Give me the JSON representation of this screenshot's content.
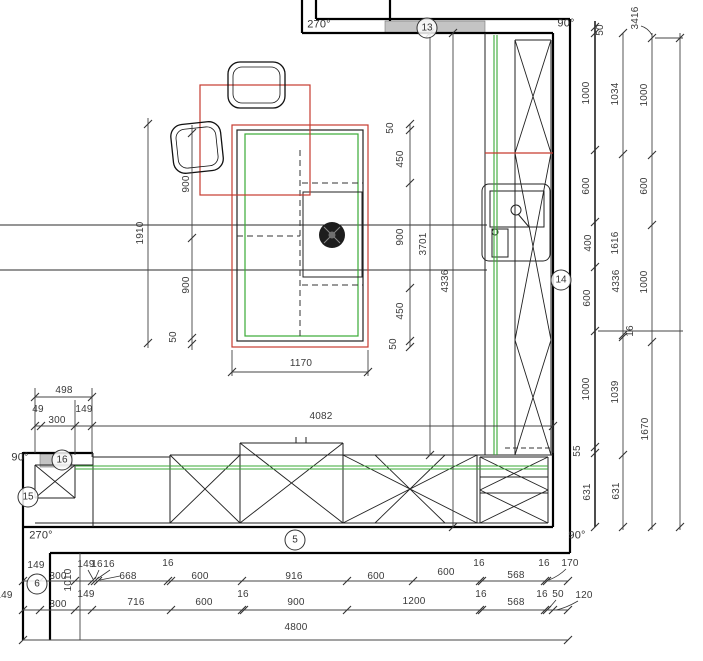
{
  "plan": {
    "description": "kitchen floor plan with dimension chains",
    "colors": {
      "wall": "#000000",
      "cabinet_outline": "#222222",
      "counter_green": "#3aaa35",
      "highlight_red": "#c63b2f",
      "dimension": "#3d3d3d",
      "opening_gray": "#c4c4c4"
    },
    "angle_labels": [
      {
        "t": "270°",
        "x": 319,
        "y": 25
      },
      {
        "t": "90°",
        "x": 566,
        "y": 24
      },
      {
        "t": "90°",
        "x": 20,
        "y": 458
      },
      {
        "t": "270°",
        "x": 41,
        "y": 536
      },
      {
        "t": "90°",
        "x": 577,
        "y": 536
      }
    ],
    "dimension_labels": [
      {
        "t": "50",
        "x": 601,
        "y": 30,
        "o": "v"
      },
      {
        "t": "3416",
        "x": 636,
        "y": 18,
        "o": "v"
      },
      {
        "t": "1000",
        "x": 587,
        "y": 93,
        "o": "v"
      },
      {
        "t": "1034",
        "x": 616,
        "y": 94,
        "o": "v"
      },
      {
        "t": "1000",
        "x": 645,
        "y": 95,
        "o": "v"
      },
      {
        "t": "600",
        "x": 587,
        "y": 186,
        "o": "v"
      },
      {
        "t": "600",
        "x": 645,
        "y": 186,
        "o": "v"
      },
      {
        "t": "400",
        "x": 589,
        "y": 243,
        "o": "v"
      },
      {
        "t": "1616",
        "x": 616,
        "y": 243,
        "o": "v"
      },
      {
        "t": "600",
        "x": 588,
        "y": 298,
        "o": "v"
      },
      {
        "t": "4336",
        "x": 617,
        "y": 281,
        "o": "v"
      },
      {
        "t": "1000",
        "x": 645,
        "y": 282,
        "o": "v"
      },
      {
        "t": "16",
        "x": 631,
        "y": 331,
        "o": "v"
      },
      {
        "t": "1000",
        "x": 587,
        "y": 389,
        "o": "v"
      },
      {
        "t": "1039",
        "x": 616,
        "y": 392,
        "o": "v"
      },
      {
        "t": "1670",
        "x": 646,
        "y": 429,
        "o": "v"
      },
      {
        "t": "55",
        "x": 578,
        "y": 451,
        "o": "v"
      },
      {
        "t": "631",
        "x": 588,
        "y": 492,
        "o": "v"
      },
      {
        "t": "631",
        "x": 617,
        "y": 491,
        "o": "v"
      },
      {
        "t": "50",
        "x": 391,
        "y": 128,
        "o": "v"
      },
      {
        "t": "450",
        "x": 401,
        "y": 159,
        "o": "v"
      },
      {
        "t": "900",
        "x": 401,
        "y": 237,
        "o": "v"
      },
      {
        "t": "3701",
        "x": 424,
        "y": 244,
        "o": "v"
      },
      {
        "t": "4336",
        "x": 446,
        "y": 281,
        "o": "v"
      },
      {
        "t": "450",
        "x": 401,
        "y": 311,
        "o": "v"
      },
      {
        "t": "50",
        "x": 394,
        "y": 344,
        "o": "v"
      },
      {
        "t": "1170",
        "x": 301,
        "y": 364,
        "o": "h"
      },
      {
        "t": "1910",
        "x": 141,
        "y": 233,
        "o": "v"
      },
      {
        "t": "900",
        "x": 187,
        "y": 184,
        "o": "v"
      },
      {
        "t": "900",
        "x": 187,
        "y": 285,
        "o": "v"
      },
      {
        "t": "50",
        "x": 174,
        "y": 337,
        "o": "v"
      },
      {
        "t": "498",
        "x": 64,
        "y": 391,
        "o": "h"
      },
      {
        "t": "49",
        "x": 38,
        "y": 410,
        "o": "h"
      },
      {
        "t": "300",
        "x": 57,
        "y": 421,
        "o": "h"
      },
      {
        "t": "149",
        "x": 84,
        "y": 410,
        "o": "h"
      },
      {
        "t": "4082",
        "x": 321,
        "y": 417,
        "o": "h"
      },
      {
        "t": "149",
        "x": 36,
        "y": 566,
        "o": "h"
      },
      {
        "t": "300",
        "x": 58,
        "y": 577,
        "o": "h"
      },
      {
        "t": "149",
        "x": 86,
        "y": 565,
        "o": "h"
      },
      {
        "t": "16",
        "x": 97,
        "y": 565,
        "o": "h"
      },
      {
        "t": "16",
        "x": 109,
        "y": 565,
        "o": "h"
      },
      {
        "t": "668",
        "x": 128,
        "y": 577,
        "o": "h"
      },
      {
        "t": "16",
        "x": 168,
        "y": 564,
        "o": "h"
      },
      {
        "t": "600",
        "x": 200,
        "y": 577,
        "o": "h"
      },
      {
        "t": "916",
        "x": 294,
        "y": 577,
        "o": "h"
      },
      {
        "t": "600",
        "x": 376,
        "y": 577,
        "o": "h"
      },
      {
        "t": "600",
        "x": 446,
        "y": 573,
        "o": "h"
      },
      {
        "t": "16",
        "x": 479,
        "y": 564,
        "o": "h"
      },
      {
        "t": "568",
        "x": 516,
        "y": 576,
        "o": "h"
      },
      {
        "t": "16",
        "x": 544,
        "y": 564,
        "o": "h"
      },
      {
        "t": "170",
        "x": 570,
        "y": 564,
        "o": "h"
      },
      {
        "t": "149",
        "x": 4,
        "y": 596,
        "o": "h"
      },
      {
        "t": "300",
        "x": 58,
        "y": 605,
        "o": "h"
      },
      {
        "t": "149",
        "x": 86,
        "y": 595,
        "o": "h"
      },
      {
        "t": "1010",
        "x": 69,
        "y": 580,
        "o": "v"
      },
      {
        "t": "716",
        "x": 136,
        "y": 603,
        "o": "h"
      },
      {
        "t": "600",
        "x": 204,
        "y": 603,
        "o": "h"
      },
      {
        "t": "16",
        "x": 243,
        "y": 595,
        "o": "h"
      },
      {
        "t": "900",
        "x": 296,
        "y": 603,
        "o": "h"
      },
      {
        "t": "1200",
        "x": 414,
        "y": 602,
        "o": "h"
      },
      {
        "t": "16",
        "x": 481,
        "y": 595,
        "o": "h"
      },
      {
        "t": "568",
        "x": 516,
        "y": 603,
        "o": "h"
      },
      {
        "t": "16",
        "x": 542,
        "y": 595,
        "o": "h"
      },
      {
        "t": "50",
        "x": 558,
        "y": 595,
        "o": "h"
      },
      {
        "t": "120",
        "x": 584,
        "y": 596,
        "o": "h"
      },
      {
        "t": "4800",
        "x": 296,
        "y": 628,
        "o": "h"
      }
    ],
    "position_badges": [
      {
        "t": "13",
        "x": 427,
        "y": 28
      },
      {
        "t": "14",
        "x": 561,
        "y": 280
      },
      {
        "t": "15",
        "x": 28,
        "y": 497
      },
      {
        "t": "16",
        "x": 62,
        "y": 460
      },
      {
        "t": "5",
        "x": 295,
        "y": 540
      },
      {
        "t": "6",
        "x": 37,
        "y": 584
      }
    ]
  }
}
